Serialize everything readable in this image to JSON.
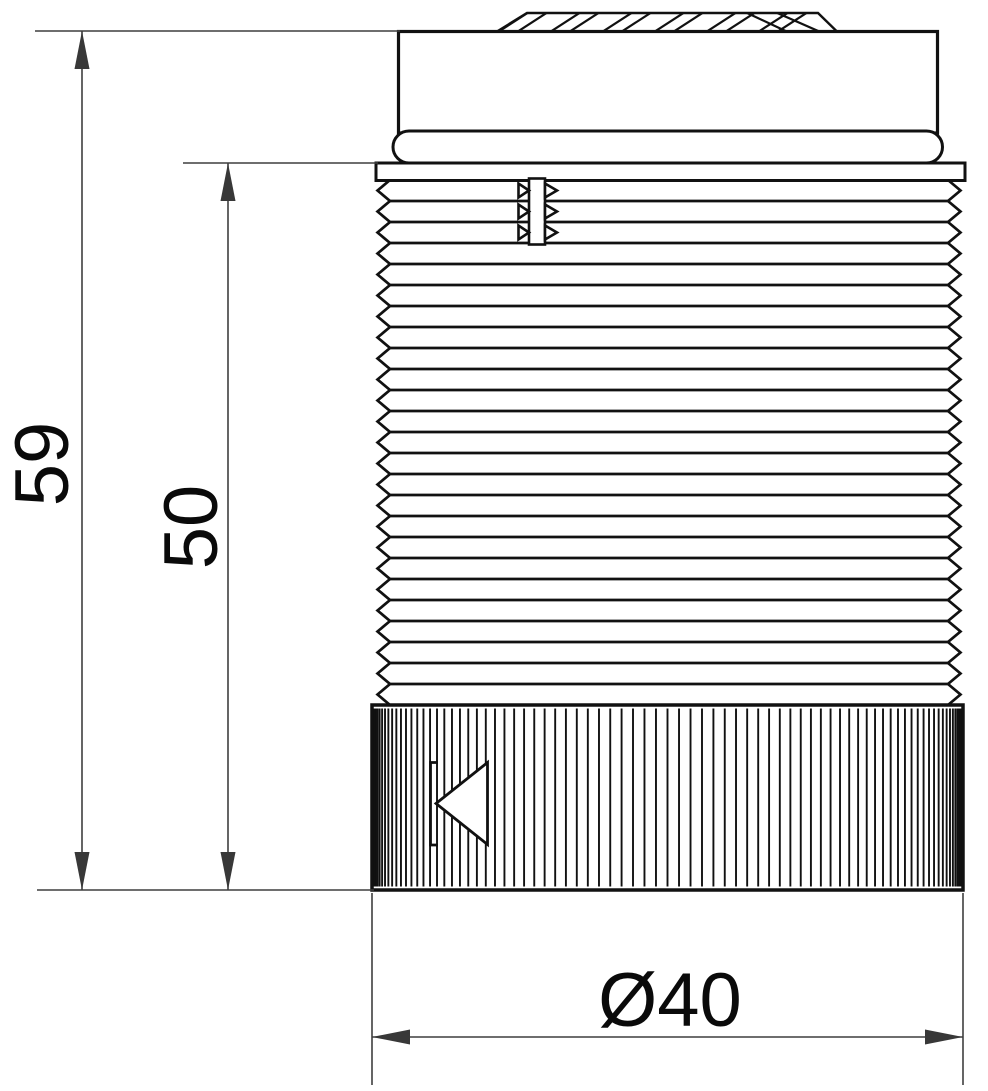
{
  "drawing": {
    "background_color": "#ffffff",
    "object_line_color": "#111111",
    "dimension_line_color": "#3f3f3f",
    "dimensions": {
      "overall_height": {
        "label": "59"
      },
      "body_height": {
        "label": "50"
      },
      "diameter": {
        "label": "Ø40"
      }
    }
  }
}
